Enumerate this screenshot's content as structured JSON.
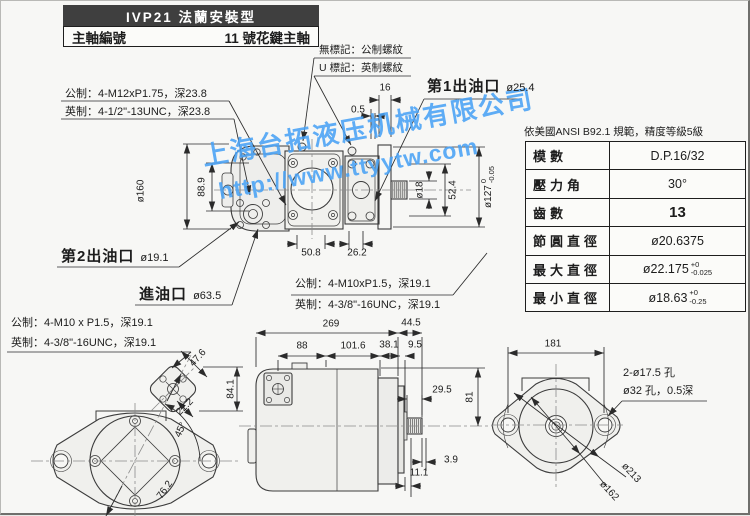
{
  "header": {
    "title": "IVP21 法蘭安裝型",
    "spindle_label": "主軸編號",
    "spindle_value": "11 號花鍵主軸"
  },
  "notes": {
    "no_mark": "無標記：公制螺紋",
    "u_mark": "U 標記：英制螺紋"
  },
  "watermark": {
    "line1": "上海台拓液压机械有限公司",
    "line2": "http://www.ttyytw.com",
    "color": "#49a2f5"
  },
  "ports": {
    "outlet1_label": "第1出油口",
    "outlet1_dia": "ø25.4",
    "outlet2_label": "第2出油口",
    "outlet2_dia": "ø19.1",
    "inlet_label": "進油口",
    "inlet_dia": "ø63.5"
  },
  "thread_specs": {
    "flange_metric": "公制：4-M12xP1.75，深23.8",
    "flange_imperial": "英制：4-1/2\"-13UNC，深23.8",
    "port2_metric": "公制：4-M10 x P1.5，深19.1",
    "port2_imperial": "英制：4-3/8\"-16UNC，深19.1",
    "port1_metric": "公制：4-M10xP1.5，深19.1",
    "port1_imperial": "英制：4-3/8\"-16UNC，深19.1"
  },
  "spline_table": {
    "title": "依美國ANSI B92.1 規範，精度等級5級",
    "rows": [
      {
        "label": "模數",
        "value": "D.P.16/32"
      },
      {
        "label": "壓力角",
        "value": "30°"
      },
      {
        "label": "齒數",
        "value": "13"
      },
      {
        "label": "節圓直徑",
        "value": "ø20.6375"
      },
      {
        "label": "最大直徑",
        "value": "ø22.175",
        "tol_top": "+0",
        "tol_bot": "-0.025"
      },
      {
        "label": "最小直徑",
        "value": "ø18.63",
        "tol_top": "+0",
        "tol_bot": "-0.25"
      }
    ]
  },
  "rear_labels": {
    "holes": "2-ø17.5 孔",
    "spotface": "ø32 孔，0.5深",
    "bolt_circle": "ø213",
    "pilot": "ø162"
  },
  "dims": {
    "shaft_len": "16",
    "shaft_offset": "0.5",
    "flange_od": "ø160",
    "port_height": "88.9",
    "shaft_dia": "ø18",
    "shaft_height": "52.4",
    "pilot_dia": "ø127",
    "pilot_tol_top": "0",
    "pilot_tol_bot": "-0.05",
    "port_span1": "50.8",
    "port_span2": "26.2",
    "total_len": "269",
    "shaft_ext": "44.5",
    "len_88": "88",
    "len_101": "101.6",
    "len_38": "38.1",
    "len_9": "9.5",
    "len_29": "29.5",
    "height_81": "81",
    "len_3_9": "3.9",
    "len_11": "11.1",
    "det_47": "47.6",
    "det_22": "22.2",
    "angle_45": "45°",
    "diag_76": "76.2",
    "det_84": "84.1",
    "rear_width": "181"
  }
}
